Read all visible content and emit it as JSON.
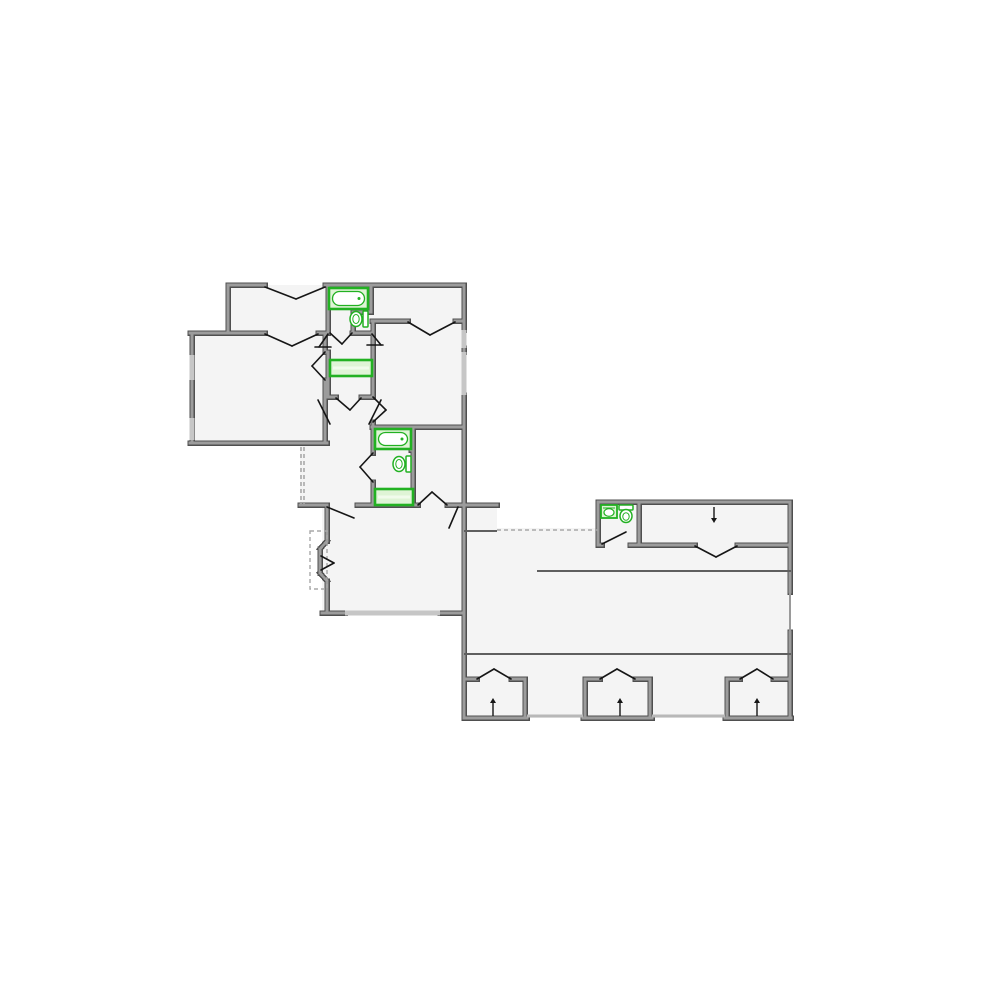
{
  "page": {
    "background": "#ffffff"
  },
  "plan": {
    "canvas": {
      "width": 1000,
      "height": 1000
    },
    "colors": {
      "floor": "#f4f4f4",
      "wall_dark": "#4f4f4f",
      "wall_light": "#9c9c9c",
      "window": "#c6c6c6",
      "window_thin": "#9a9a9a",
      "door": "#161616",
      "dashed": "#a8a8a8",
      "threshold": "#b8b8b8",
      "interior_line": "#5f5f5f",
      "fixture_green": "#22b122",
      "fixture_fill": "#dff4d6",
      "fixture_fill_light": "#f1fbec",
      "white": "#ffffff"
    },
    "floors": [
      {
        "id": "floor-house",
        "points": "228,285 464,285 464,613 322,613 322,506 300,506 300,443 190,443 190,333 228,333"
      },
      {
        "id": "floor-garage",
        "points": "464,506 497,506 497,528 791,528 791,718 464,718"
      },
      {
        "id": "floor-storage-strip",
        "points": "598,502 790,502 790,545 598,545"
      }
    ],
    "walls": [
      [
        228,
        285,
        265,
        285
      ],
      [
        325,
        285,
        464,
        285
      ],
      [
        228,
        285,
        228,
        333
      ],
      [
        190,
        333,
        265,
        333
      ],
      [
        318,
        333,
        328,
        333
      ],
      [
        352,
        333,
        373,
        333
      ],
      [
        192,
        333,
        192,
        443
      ],
      [
        190,
        443,
        327,
        443
      ],
      [
        325,
        333,
        325,
        352
      ],
      [
        325,
        380,
        325,
        443
      ],
      [
        328,
        285,
        328,
        333
      ],
      [
        371,
        285,
        371,
        312
      ],
      [
        353,
        312,
        371,
        312
      ],
      [
        353,
        312,
        353,
        333
      ],
      [
        372,
        321,
        408,
        321
      ],
      [
        455,
        321,
        464,
        321
      ],
      [
        464,
        285,
        464,
        330
      ],
      [
        464,
        348,
        464,
        352
      ],
      [
        464,
        395,
        464,
        506
      ],
      [
        373,
        321,
        373,
        397
      ],
      [
        373,
        422,
        373,
        453
      ],
      [
        373,
        482,
        373,
        505
      ],
      [
        328,
        352,
        328,
        397
      ],
      [
        328,
        397,
        336,
        397
      ],
      [
        361,
        397,
        372,
        397
      ],
      [
        372,
        427,
        464,
        427
      ],
      [
        411,
        427,
        411,
        450
      ],
      [
        413,
        427,
        413,
        505
      ],
      [
        300,
        505,
        327,
        505
      ],
      [
        357,
        505,
        418,
        505
      ],
      [
        447,
        505,
        497,
        505
      ],
      [
        374,
        505,
        413,
        505
      ],
      [
        327,
        506,
        327,
        541
      ],
      [
        327,
        541,
        320,
        549
      ],
      [
        320,
        549,
        320,
        573
      ],
      [
        320,
        573,
        327,
        581
      ],
      [
        327,
        581,
        327,
        613
      ],
      [
        322,
        613,
        345,
        613
      ],
      [
        440,
        613,
        464,
        613
      ],
      [
        464,
        506,
        464,
        718
      ],
      [
        598,
        502,
        598,
        545
      ],
      [
        639,
        502,
        639,
        545
      ],
      [
        598,
        502,
        790,
        502
      ],
      [
        598,
        545,
        602,
        545
      ],
      [
        630,
        545,
        639,
        545
      ],
      [
        639,
        545,
        695,
        545
      ],
      [
        737,
        545,
        790,
        545
      ],
      [
        790,
        502,
        790,
        592
      ],
      [
        790,
        632,
        790,
        718
      ],
      [
        464,
        718,
        527,
        718
      ],
      [
        583,
        718,
        652,
        718
      ],
      [
        725,
        718,
        791,
        718
      ],
      [
        525,
        679,
        525,
        718
      ],
      [
        585,
        679,
        585,
        718
      ],
      [
        650,
        679,
        650,
        718
      ],
      [
        727,
        679,
        727,
        718
      ],
      [
        464,
        679,
        477,
        679
      ],
      [
        511,
        679,
        525,
        679
      ],
      [
        585,
        679,
        600,
        679
      ],
      [
        635,
        679,
        650,
        679
      ],
      [
        727,
        679,
        740,
        679
      ],
      [
        773,
        679,
        790,
        679
      ]
    ],
    "windows": [
      [
        192,
        355,
        192,
        380
      ],
      [
        192,
        418,
        192,
        440
      ],
      [
        464,
        330,
        464,
        348
      ],
      [
        464,
        352,
        464,
        395
      ],
      [
        345,
        613,
        440,
        613
      ]
    ],
    "windows_thin": [
      [
        790,
        592,
        790,
        632
      ]
    ],
    "thin_lines": [
      [
        537,
        571,
        791,
        571
      ],
      [
        464,
        654,
        791,
        654
      ],
      [
        464,
        531,
        497,
        531
      ]
    ],
    "thresholds": [
      [
        527,
        716,
        583,
        716
      ],
      [
        652,
        716,
        725,
        716
      ]
    ],
    "dashed_lines": [
      [
        301,
        447,
        301,
        504
      ],
      [
        304,
        447,
        304,
        504
      ],
      [
        497,
        530,
        598,
        530
      ]
    ],
    "dashed_rects": [
      {
        "x": 310,
        "y": 531,
        "w": 17,
        "h": 58
      }
    ],
    "door_lines": [
      [
        265,
        287,
        296,
        299
      ],
      [
        325,
        287,
        296,
        299
      ],
      [
        265,
        334,
        292,
        346
      ],
      [
        318,
        334,
        292,
        346
      ],
      [
        330,
        333,
        342,
        344
      ],
      [
        352,
        333,
        342,
        344
      ],
      [
        408,
        322,
        430,
        335
      ],
      [
        455,
        322,
        430,
        335
      ],
      [
        373,
        397,
        386,
        410
      ],
      [
        373,
        422,
        386,
        410
      ],
      [
        373,
        453,
        360,
        467
      ],
      [
        373,
        482,
        360,
        467
      ],
      [
        325,
        352,
        312,
        366
      ],
      [
        325,
        380,
        312,
        366
      ],
      [
        336,
        398,
        350,
        410
      ],
      [
        361,
        398,
        350,
        410
      ],
      [
        328,
        334,
        319,
        347
      ],
      [
        315,
        347,
        331,
        347
      ],
      [
        372,
        334,
        381,
        345
      ],
      [
        367,
        345,
        383,
        345
      ],
      [
        318,
        400,
        330,
        424
      ],
      [
        381,
        400,
        369,
        424
      ],
      [
        327,
        507,
        354,
        518
      ],
      [
        418,
        505,
        432,
        492
      ],
      [
        447,
        505,
        432,
        492
      ],
      [
        458,
        507,
        449,
        528
      ],
      [
        321,
        556,
        334,
        563
      ],
      [
        321,
        570,
        334,
        563
      ],
      [
        602,
        544,
        626,
        532
      ],
      [
        695,
        546,
        716,
        557
      ],
      [
        737,
        546,
        716,
        557
      ],
      [
        477,
        679,
        494,
        669
      ],
      [
        494,
        669,
        511,
        679
      ],
      [
        600,
        679,
        617,
        669
      ],
      [
        617,
        669,
        635,
        679
      ],
      [
        740,
        679,
        757,
        669
      ],
      [
        757,
        669,
        773,
        679
      ]
    ],
    "arrows": [
      {
        "x": 714,
        "y1": 507,
        "y2": 518,
        "dir": "down"
      },
      {
        "x": 493,
        "y1": 716,
        "y2": 703,
        "dir": "up"
      },
      {
        "x": 620,
        "y1": 716,
        "y2": 703,
        "dir": "up"
      },
      {
        "x": 757,
        "y1": 716,
        "y2": 703,
        "dir": "up"
      }
    ],
    "fixtures": {
      "bathtubs": [
        {
          "x": 329,
          "y": 288,
          "w": 39,
          "h": 21
        },
        {
          "x": 375,
          "y": 429,
          "w": 36,
          "h": 20
        }
      ],
      "vanities": [
        {
          "x": 330,
          "y": 360,
          "w": 42,
          "h": 16
        },
        {
          "x": 375,
          "y": 489,
          "w": 38,
          "h": 16
        }
      ],
      "toilets": [
        {
          "cx": 356,
          "cy": 319,
          "facing": "left"
        },
        {
          "cx": 399,
          "cy": 464,
          "facing": "left"
        },
        {
          "cx": 626,
          "cy": 515,
          "facing": "down"
        }
      ],
      "sinks": [
        {
          "x": 601,
          "y": 505,
          "w": 16,
          "h": 13
        }
      ]
    }
  }
}
